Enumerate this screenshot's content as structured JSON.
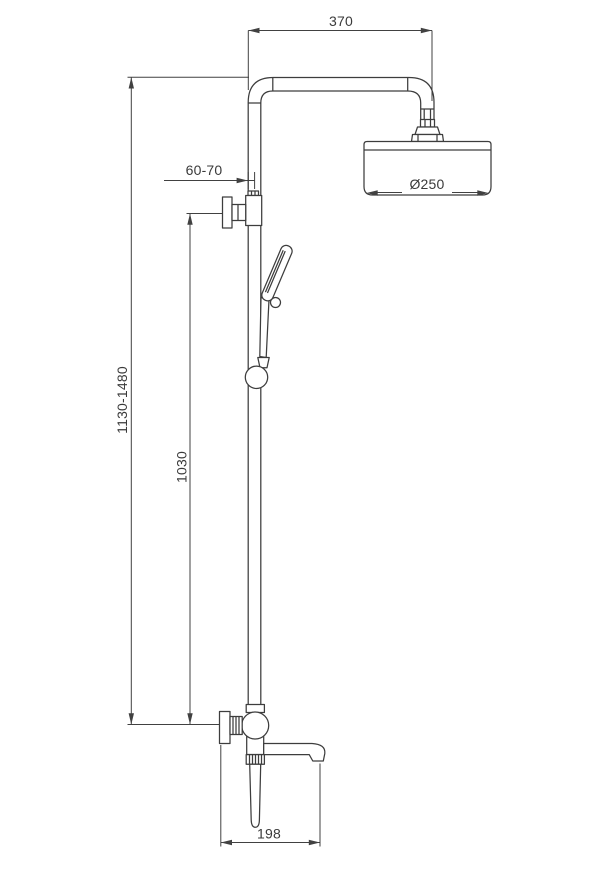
{
  "drawing": {
    "type": "technical-dimension-drawing",
    "subject": "wall-mounted shower column with overhead shower, hand shower and tub spout",
    "background_color": "#ffffff",
    "line_color": "#3d3d3d"
  },
  "dimensions": {
    "arm_reach": "370",
    "wall_distance": "60-70",
    "head_diameter": "Ø250",
    "overall_height": "1130-1480",
    "riser_height": "1030",
    "spout_reach": "198"
  }
}
